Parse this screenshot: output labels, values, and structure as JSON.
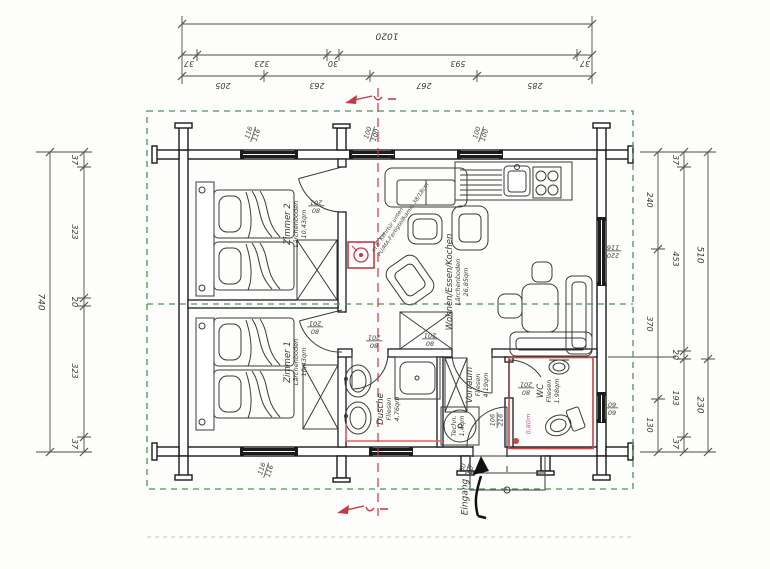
{
  "drawing": {
    "kind": "floor-plan"
  },
  "colors": {
    "wall": "#1a1a1a",
    "furniture": "#3a3a3a",
    "dimension": "#4a4a4a",
    "roof_dash_green": "#4a9555",
    "section_red": "#c23a44",
    "wc_outline_red": "#cc4444",
    "heating_pink": "#e06060",
    "note_magenta": "#c45a9e"
  },
  "dims": {
    "top": {
      "total": "1020",
      "mid": [
        "37",
        "323",
        "30",
        "593",
        "37"
      ],
      "inner": [
        "205",
        "263",
        "267",
        "285"
      ]
    },
    "left": {
      "total": "740",
      "inner": [
        "37",
        "323",
        "20",
        "323",
        "37"
      ]
    },
    "right": {
      "a": [
        "240",
        "370",
        "130"
      ],
      "b": [
        "37",
        "453",
        "20",
        "193",
        "37"
      ],
      "c": [
        "510",
        "230"
      ]
    }
  },
  "rooms": {
    "zimmer2": {
      "name": "Zimmer 2",
      "floor": "Lärchenboden",
      "area": "10,43qm"
    },
    "zimmer1": {
      "name": "Zimmer 1",
      "floor": "Lärchenboden",
      "area": "10,43qm"
    },
    "wohnen": {
      "name": "Wohnen/Essen/Kochen",
      "floor": "Lärchenboden",
      "area": "26,85qm"
    },
    "dusche": {
      "name": "Dusche",
      "floor": "Fliesen",
      "area": "4,76qm"
    },
    "vorraum": {
      "name": "Vorraum",
      "floor": "Fliesen",
      "area": "4,19qm"
    },
    "wc": {
      "name": "WC",
      "floor": "Fliesen",
      "area": "1,98qm"
    },
    "techn": {
      "name": "Techn.",
      "area": "1,4qm"
    }
  },
  "windows": {
    "top1": [
      "116",
      "116"
    ],
    "top2": [
      "100",
      "100"
    ],
    "top3": [
      "100",
      "100"
    ],
    "bottom1": [
      "116",
      "116"
    ],
    "bottom2": [
      "80",
      "80"
    ],
    "right1": [
      "220",
      "116"
    ],
    "right2": [
      "60",
      "60"
    ]
  },
  "doors": {
    "std": [
      "80",
      "201"
    ],
    "entrance": [
      "106",
      "216"
    ]
  },
  "labels": {
    "eingang": "Eingang",
    "wc_note": "0,80m",
    "chimney1": "m 6. Kehrtür unten",
    "chimney2": "PU/MA-Fertigteilkamin 38/18cm"
  }
}
